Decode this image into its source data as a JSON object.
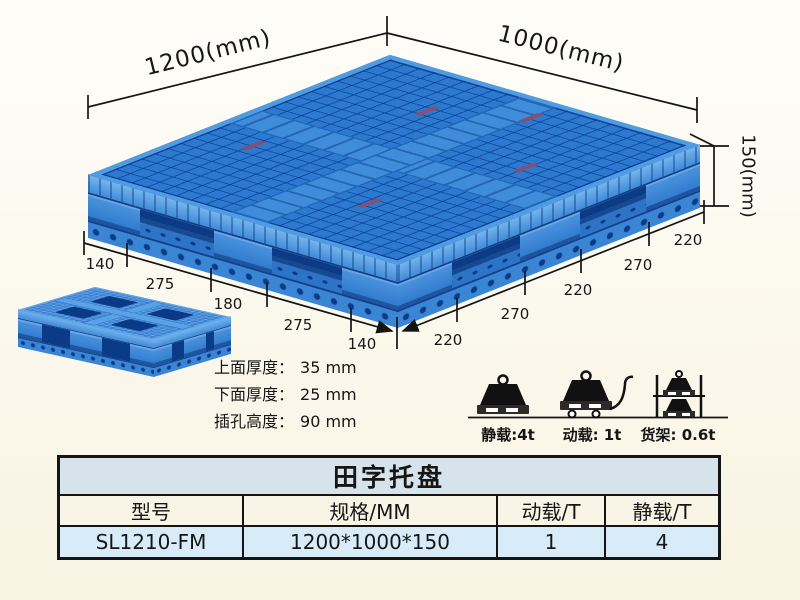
{
  "annotations": {
    "dim_top_left_edge": "1200(mm)",
    "dim_top_right_edge": "1000(mm)",
    "dim_height": "150(mm)",
    "left_edge_segments": [
      "140",
      "275",
      "180",
      "275",
      "140"
    ],
    "right_edge_segments": [
      "220",
      "270",
      "220",
      "270",
      "220"
    ],
    "thickness_notes": [
      {
        "label": "上面厚度：",
        "value": "35 mm"
      },
      {
        "label": "下面厚度：",
        "value": "25 mm"
      },
      {
        "label": "插孔高度：",
        "value": "90 mm"
      }
    ],
    "load_ratings": [
      {
        "icon": "static-load-weight-icon",
        "label": "静载:4t"
      },
      {
        "icon": "dynamic-load-trolley-icon",
        "label": "动载: 1t"
      },
      {
        "icon": "rack-load-shelf-icon",
        "label": "货架: 0.6t"
      }
    ]
  },
  "spec_table": {
    "title": "田字托盘",
    "headers": [
      "型号",
      "规格/MM",
      "动载/T",
      "静载/T"
    ],
    "rows": [
      [
        "SL1210-FM",
        "1200*1000*150",
        "1",
        "4"
      ]
    ]
  },
  "colors": {
    "pallet_blue": "#2c79d0",
    "pallet_light_blue": "#5aa2e6",
    "pallet_dark_blue": "#0b3a86",
    "label_mark_red": "#8e4e6b",
    "line_black": "#141414",
    "table_title_bg": "#d6e3ea",
    "table_header_bg": "#f8f4e6",
    "table_row_bg": "#d7ecf8",
    "background_cream": "#fbf8ec"
  }
}
